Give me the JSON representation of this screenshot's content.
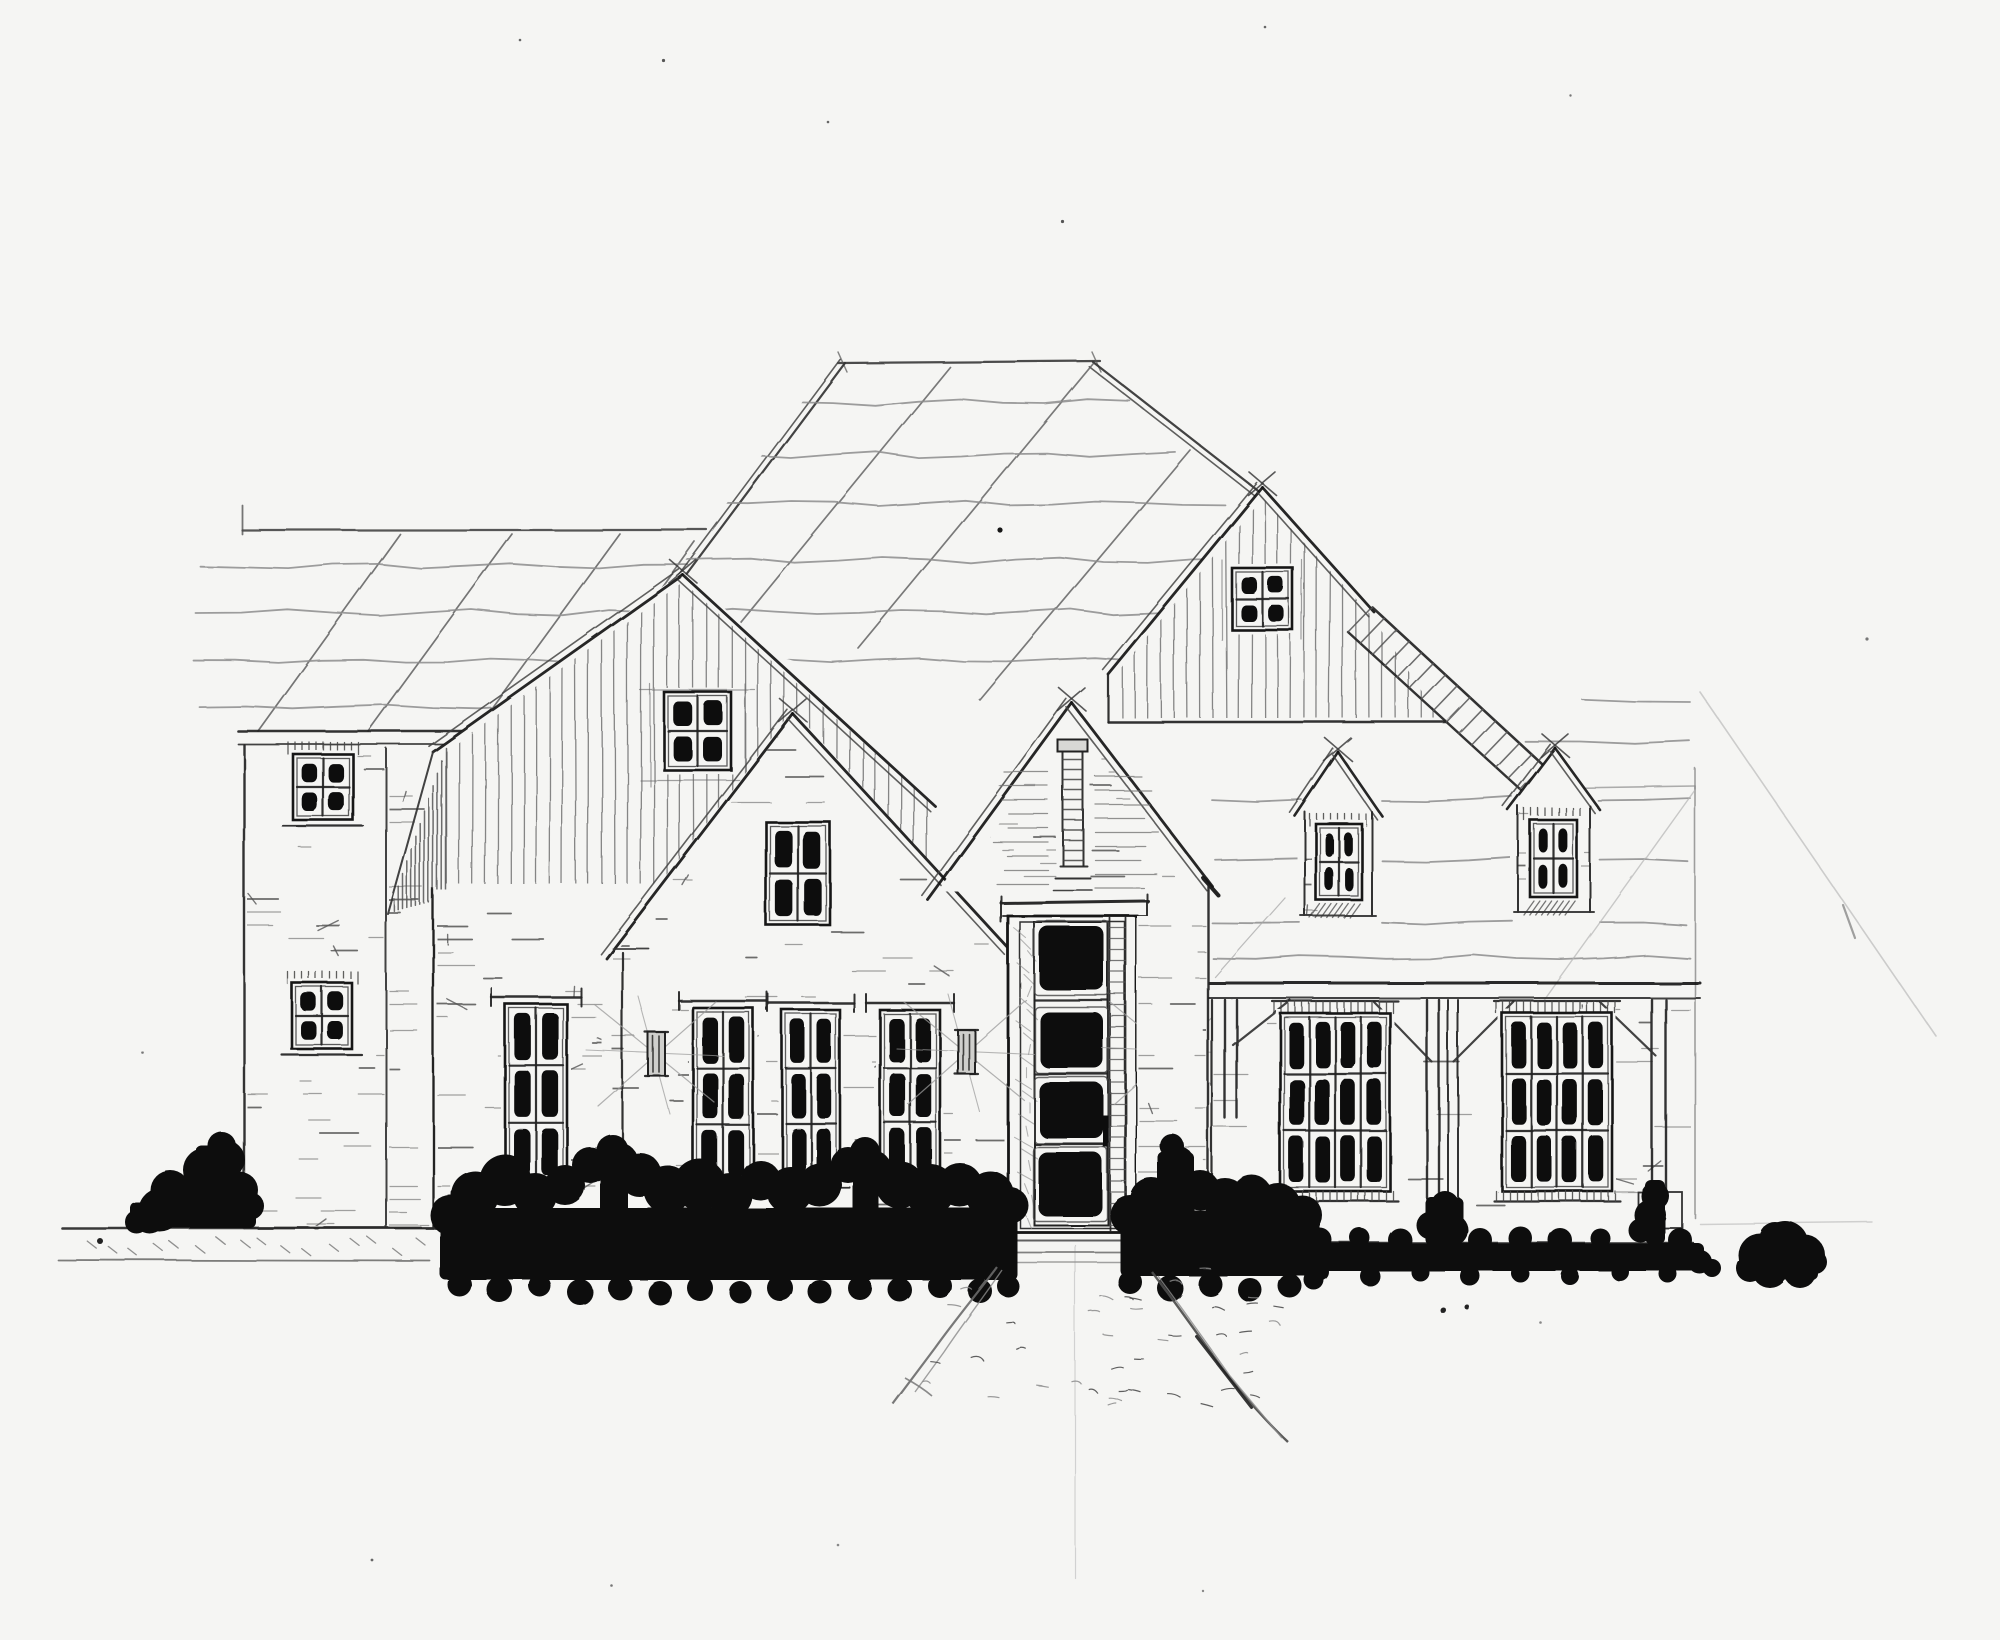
{
  "document": {
    "domain": "architectural drawing",
    "title": "Hand-drawn front elevation sketch of a farmhouse-style residence",
    "medium": "pencil and ink on white paper",
    "view": "front elevation"
  },
  "palette": {
    "paper": "#f5f5f3",
    "ink": "#141414",
    "pencil_dark": "#3a3a3a",
    "pencil_mid": "#6f6f6f",
    "pencil_light": "#9c9c9c",
    "construction": "#c2c2c2",
    "foliage": "#0b0b0b"
  },
  "scene": {
    "sections": [
      {
        "name": "left-tower",
        "label": "Two-story brick tower",
        "windows": "two square 4-pane windows"
      },
      {
        "name": "left-gable",
        "label": "Board-and-batten gable",
        "windows": "one square 4-pane window"
      },
      {
        "name": "center-gable",
        "label": "Steep brick gable",
        "windows": "one tall 4-pane window"
      },
      {
        "name": "main-roof",
        "label": "Large sketched roof with wavy shingle lines and perspective guides"
      },
      {
        "name": "entry",
        "label": "Gabled entry with brick vent stack, stacked-panel door and wall sconces"
      },
      {
        "name": "right-gable",
        "label": "Board-and-batten gable with stepped slatted rake"
      },
      {
        "name": "right-wing",
        "label": "Roof wing with two gabled dormers, timber posts and two 12-pane windows"
      },
      {
        "name": "landscape",
        "label": "Ink-blotted hedges and shrubs with tapering front walkway"
      }
    ],
    "counts": {
      "gabled_dormers": 2,
      "small_square_windows": 6,
      "tall_triple_windows": 4,
      "large_grid_windows": 2,
      "door_panels": 4,
      "wall_sconces": 3,
      "timber_posts": 3
    }
  }
}
